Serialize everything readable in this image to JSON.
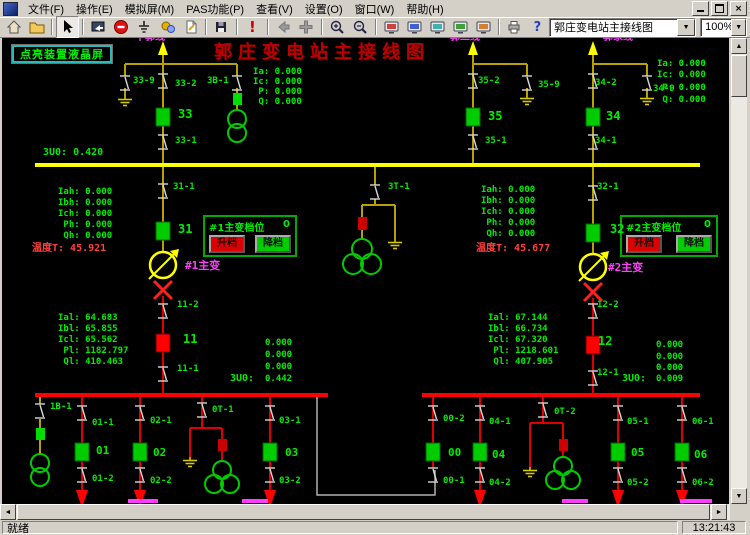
{
  "window": {
    "menu_items": [
      "文件(F)",
      "操作(E)",
      "模拟屏(M)",
      "PAS功能(P)",
      "查看(V)",
      "设置(O)",
      "窗口(W)",
      "帮助(H)"
    ],
    "buttons": {
      "minimize": "minimize",
      "restore": "restore",
      "close": "×"
    }
  },
  "toolbar": {
    "view_selector": "郭庄变电站主接线图",
    "zoom_selector": "100%",
    "icons": [
      "home",
      "open-folder",
      "cursor",
      "screen-arrow",
      "stop",
      "ground",
      "gears",
      "edit-page",
      "save",
      "alarm",
      "back",
      "move",
      "zoom-in",
      "zoom-out",
      "crt-1",
      "crt-2",
      "crt-3",
      "crt-4",
      "crt-5",
      "printer",
      "help"
    ]
  },
  "statusbar": {
    "ready_text": "就绪",
    "clock": "13:21:43"
  },
  "diagram": {
    "title": "郭庄变电站主接线图",
    "lcd_button_label": "点亮装置液晶屏",
    "tap_panels": [
      {
        "title": "#1主变档位",
        "value": "0",
        "raise": "升档",
        "lower": "降档"
      },
      {
        "title": "#2主变档位",
        "value": "0",
        "raise": "升档",
        "lower": "降档"
      }
    ],
    "labels": [
      {
        "t": "干郭线",
        "x": 133,
        "y": -5,
        "c": "#ff3cff",
        "s": 10,
        "n": "feeder-name-1"
      },
      {
        "t": "郭二线",
        "x": 448,
        "y": -5,
        "c": "#ff3cff",
        "s": 10,
        "n": "feeder-name-2"
      },
      {
        "t": "郭家线",
        "x": 601,
        "y": -5,
        "c": "#ff3cff",
        "s": 10,
        "n": "feeder-name-3"
      },
      {
        "t": "Ia: 0.000",
        "x": 251,
        "y": 30
      },
      {
        "t": "Ic: 0.000",
        "x": 251,
        "y": 40
      },
      {
        "t": " P: 0.000",
        "x": 251,
        "y": 50
      },
      {
        "t": " Q: 0.000",
        "x": 251,
        "y": 60
      },
      {
        "t": "Ia: 0.000",
        "x": 655,
        "y": 22
      },
      {
        "t": "Ic: 0.000",
        "x": 655,
        "y": 33
      },
      {
        "t": " P: 0.000",
        "x": 655,
        "y": 46
      },
      {
        "t": " Q: 0.000",
        "x": 655,
        "y": 58
      },
      {
        "t": "33-9",
        "x": 131,
        "y": 39
      },
      {
        "t": "33-2",
        "x": 173,
        "y": 42
      },
      {
        "t": "3B-1",
        "x": 205,
        "y": 39
      },
      {
        "t": "33",
        "x": 176,
        "y": 70,
        "s": 12
      },
      {
        "t": "33-1",
        "x": 173,
        "y": 99
      },
      {
        "t": "35-2",
        "x": 476,
        "y": 39
      },
      {
        "t": "35-9",
        "x": 536,
        "y": 43
      },
      {
        "t": "35",
        "x": 486,
        "y": 72,
        "s": 12
      },
      {
        "t": "35-1",
        "x": 483,
        "y": 99
      },
      {
        "t": "34-2",
        "x": 593,
        "y": 41
      },
      {
        "t": "34-9",
        "x": 651,
        "y": 47
      },
      {
        "t": "34",
        "x": 604,
        "y": 72,
        "s": 12
      },
      {
        "t": "34-1",
        "x": 593,
        "y": 99
      },
      {
        "t": "3U0: 0.420",
        "x": 41,
        "y": 110,
        "s": 10
      },
      {
        "t": "Iah: 0.000",
        "x": 56,
        "y": 150
      },
      {
        "t": "Ibh: 0.000",
        "x": 56,
        "y": 161
      },
      {
        "t": "Ich: 0.000",
        "x": 56,
        "y": 172
      },
      {
        "t": " Ph: 0.000",
        "x": 56,
        "y": 183
      },
      {
        "t": " Qh: 0.000",
        "x": 56,
        "y": 194
      },
      {
        "t": "温度T: 45.921",
        "x": 30,
        "y": 206,
        "c": "#ff4040",
        "s": 10
      },
      {
        "t": "Iah: 0.000",
        "x": 479,
        "y": 148
      },
      {
        "t": "Ibh: 0.000",
        "x": 479,
        "y": 159
      },
      {
        "t": "Ich: 0.000",
        "x": 479,
        "y": 170
      },
      {
        "t": " Ph: 0.000",
        "x": 479,
        "y": 181
      },
      {
        "t": " Qh: 0.000",
        "x": 479,
        "y": 192
      },
      {
        "t": "温度T: 45.677",
        "x": 474,
        "y": 206,
        "c": "#ff4040",
        "s": 10
      },
      {
        "t": "31-1",
        "x": 171,
        "y": 145
      },
      {
        "t": "31",
        "x": 176,
        "y": 185,
        "s": 12
      },
      {
        "t": "3T-1",
        "x": 386,
        "y": 145
      },
      {
        "t": "32-1",
        "x": 595,
        "y": 145
      },
      {
        "t": "32",
        "x": 608,
        "y": 185,
        "s": 12
      },
      {
        "t": "#1主变",
        "x": 183,
        "y": 222,
        "c": "#ff40ff",
        "s": 11
      },
      {
        "t": "#2主变",
        "x": 606,
        "y": 224,
        "c": "#ff40ff",
        "s": 11
      },
      {
        "t": "11-2",
        "x": 175,
        "y": 263
      },
      {
        "t": "11",
        "x": 181,
        "y": 295,
        "s": 12
      },
      {
        "t": "11-1",
        "x": 175,
        "y": 327
      },
      {
        "t": "12-2",
        "x": 595,
        "y": 263
      },
      {
        "t": "12",
        "x": 596,
        "y": 297,
        "s": 12
      },
      {
        "t": "12-1",
        "x": 595,
        "y": 331
      },
      {
        "t": "Ial: 64.683",
        "x": 56,
        "y": 276
      },
      {
        "t": "Ibl: 65.855",
        "x": 56,
        "y": 287
      },
      {
        "t": "Icl: 65.562",
        "x": 56,
        "y": 298
      },
      {
        "t": " Pl: 1182.797",
        "x": 56,
        "y": 309
      },
      {
        "t": " Ql: 410.463",
        "x": 56,
        "y": 320
      },
      {
        "t": "Ial: 67.144",
        "x": 486,
        "y": 276
      },
      {
        "t": "Ibl: 66.734",
        "x": 486,
        "y": 287
      },
      {
        "t": "Icl: 67.320",
        "x": 486,
        "y": 298
      },
      {
        "t": " Pl: 1218.601",
        "x": 486,
        "y": 309
      },
      {
        "t": " Ql: 407.905",
        "x": 486,
        "y": 320
      },
      {
        "t": "0.000",
        "x": 263,
        "y": 301
      },
      {
        "t": "0.000",
        "x": 263,
        "y": 313
      },
      {
        "t": "0.000",
        "x": 263,
        "y": 325
      },
      {
        "t": "3U0:",
        "x": 228,
        "y": 336,
        "s": 10
      },
      {
        "t": "0.442",
        "x": 263,
        "y": 337
      },
      {
        "t": "0.000",
        "x": 654,
        "y": 303
      },
      {
        "t": "0.000",
        "x": 654,
        "y": 315
      },
      {
        "t": "0.000",
        "x": 654,
        "y": 326
      },
      {
        "t": "3U0:",
        "x": 620,
        "y": 336,
        "s": 10
      },
      {
        "t": "0.009",
        "x": 654,
        "y": 337
      },
      {
        "t": "1B-1",
        "x": 48,
        "y": 365
      },
      {
        "t": "01-1",
        "x": 90,
        "y": 381
      },
      {
        "t": "01",
        "x": 94,
        "y": 407,
        "s": 11
      },
      {
        "t": "01-2",
        "x": 90,
        "y": 437
      },
      {
        "t": "02-1",
        "x": 148,
        "y": 379
      },
      {
        "t": "02",
        "x": 151,
        "y": 409,
        "s": 11
      },
      {
        "t": "02-2",
        "x": 148,
        "y": 439
      },
      {
        "t": "0T-1",
        "x": 210,
        "y": 368
      },
      {
        "t": "03-1",
        "x": 277,
        "y": 379
      },
      {
        "t": "03",
        "x": 283,
        "y": 409,
        "s": 11
      },
      {
        "t": "03-2",
        "x": 277,
        "y": 439
      },
      {
        "t": "00-2",
        "x": 441,
        "y": 377
      },
      {
        "t": "00",
        "x": 446,
        "y": 409,
        "s": 11
      },
      {
        "t": "00-1",
        "x": 441,
        "y": 439
      },
      {
        "t": "04-1",
        "x": 487,
        "y": 380
      },
      {
        "t": "04",
        "x": 490,
        "y": 411,
        "s": 11
      },
      {
        "t": "04-2",
        "x": 487,
        "y": 441
      },
      {
        "t": "0T-2",
        "x": 552,
        "y": 370
      },
      {
        "t": "05-1",
        "x": 625,
        "y": 380
      },
      {
        "t": "05",
        "x": 629,
        "y": 409,
        "s": 11
      },
      {
        "t": "05-2",
        "x": 625,
        "y": 441
      },
      {
        "t": "06-1",
        "x": 690,
        "y": 380
      },
      {
        "t": "06",
        "x": 692,
        "y": 411,
        "s": 11
      },
      {
        "t": "06-2",
        "x": 690,
        "y": 441
      }
    ]
  },
  "colors": {
    "green": "#00ee00",
    "magenta": "#ff3cff",
    "bus_10kv": "#ff0000",
    "bus_35kv": "#ffff00",
    "title_red": "#bb0000"
  }
}
